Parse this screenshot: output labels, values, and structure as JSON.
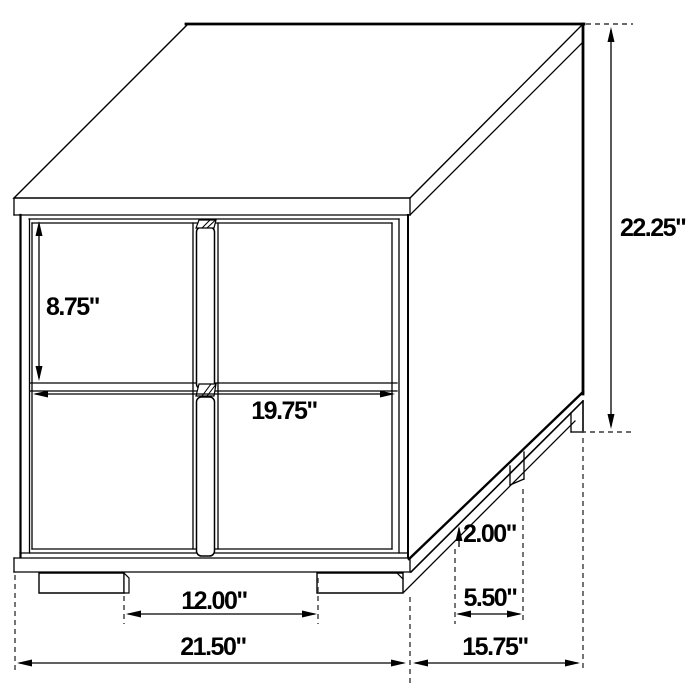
{
  "diagram": {
    "subject": "two-drawer nightstand isometric line drawing with dimensions",
    "units": "inches",
    "background": "#ffffff",
    "line_color": "#000000",
    "labels": {
      "drawer_height": "8.75\"",
      "overall_height": "22.25\"",
      "drawer_width": "19.75\"",
      "leg_height": "2.00\"",
      "front_leg_spacing": "12.00\"",
      "overall_width": "21.50\"",
      "side_leg_inset": "5.50\"",
      "overall_depth": "15.75\""
    },
    "values": {
      "drawer_height_in": 8.75,
      "overall_height_in": 22.25,
      "drawer_width_in": 19.75,
      "leg_height_in": 2.0,
      "front_leg_spacing_in": 12.0,
      "overall_width_in": 21.5,
      "side_leg_inset_in": 5.5,
      "overall_depth_in": 15.75
    }
  }
}
